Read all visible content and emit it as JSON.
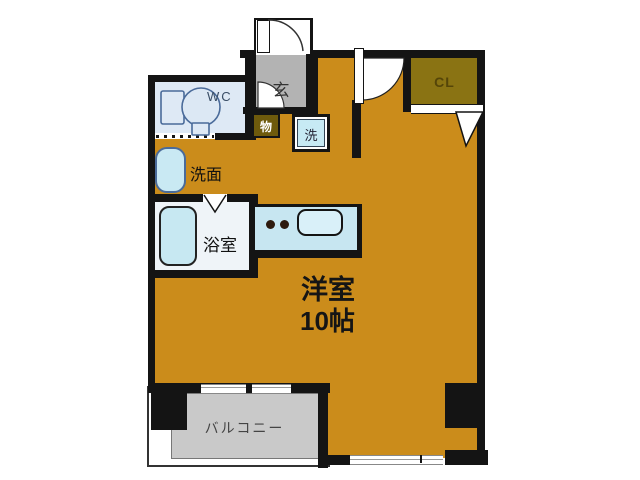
{
  "floorplan": {
    "main_room": {
      "name": "洋室",
      "size": "10帖"
    },
    "rooms": {
      "entrance": "玄",
      "toilet": "WC",
      "storage": "物",
      "washer": "洗",
      "washbasin": "洗面",
      "bathroom": "浴室",
      "closet": "CL",
      "balcony": "バルコニー"
    },
    "colors": {
      "floor_orange": "#CB8C1B",
      "closet_olive": "#8A7313",
      "storage_olive": "#6E5A0C",
      "entrance_gray": "#B3B3B3",
      "balcony_gray": "#C9C9C9",
      "fixture_blue": "#C7E8F2",
      "wc_floor_blue": "#DEE9F5",
      "wall_black": "#141414"
    }
  }
}
